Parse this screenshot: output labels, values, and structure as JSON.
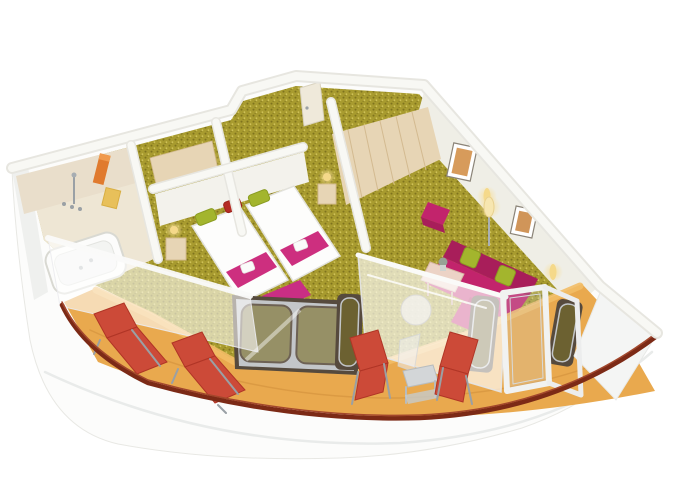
{
  "meta": {
    "description": "3D isometric cutaway rendering of a cruise-ship balcony suite floor plan",
    "width_px": 680,
    "height_px": 486
  },
  "colors": {
    "background": "#ffffff",
    "hull_white": "#fcfcfb",
    "hull_seam": "#e9ebea",
    "wall_cream": "#efeee6",
    "wall_cap": "#f8f8f4",
    "wall_cap_edge": "#e7e6e0",
    "bath_tile": "#e9decb",
    "bath_floor": "#eee6d4",
    "wood_light": "#e7d5b5",
    "wood_dark": "#d3ba90",
    "carpet_base": "#a89b2f",
    "carpet_dot_dark": "#7f731d",
    "carpet_dot_light": "#cfc258",
    "magenta": "#c2246c",
    "magenta_dark": "#a81e5a",
    "pink_runner": "#cd2f7f",
    "pink_bench": "#c92e84",
    "green_cushion": "#a3b52d",
    "red_cushion": "#b52c24",
    "lounger_red": "#cc4a38",
    "lounger_red_dark": "#b03526",
    "deck_amber": "#e9a94e",
    "deck_amber_light": "#f2bc66",
    "rail_red": "#7c2a16",
    "window_frame": "#564a3d",
    "window_glass": "rgba(122,112,42,0.62)",
    "metal_silver": "#c3c6c9",
    "frame_white": "#f1f2f1",
    "lamp_glow": "#f5d98a",
    "towel_orange": "#e07a2e",
    "towel_yellow": "#e8c05a",
    "art_orange": "#d08a3e",
    "table_pink_beige": "#ecd3c6"
  },
  "scene": {
    "type": "3d-floorplan-rendering",
    "rooms": [
      {
        "name": "bathroom",
        "features": [
          "bathtub",
          "shower-fixtures",
          "orange-towel",
          "yellow-towels",
          "tiled-walls"
        ]
      },
      {
        "name": "entrance-hall",
        "features": [
          "entry-door",
          "wood-wardrobe",
          "ceiling-light-glow"
        ]
      },
      {
        "name": "bedroom",
        "features": [
          "twin-beds",
          "white-duvets",
          "pink-bed-runners",
          "folded-towels",
          "green-pillows",
          "red-pillow",
          "bedside-tables",
          "bedside-lamps",
          "pink-bench",
          "double-window"
        ]
      },
      {
        "name": "living-room",
        "features": [
          "magenta-sofa",
          "green-cushions",
          "magenta-armchair",
          "magenta-ottoman",
          "coffee-table",
          "plant",
          "floor-lamp",
          "wall-art",
          "wall-lamps",
          "wood-wardrobe-wall"
        ]
      },
      {
        "name": "balcony",
        "features": [
          "red-sun-loungers",
          "red-folding-chairs",
          "side-table",
          "open-glass-door",
          "white-balustrade",
          "dark-red-cap-rail",
          "amber-deck",
          "translucent-windbreak"
        ]
      }
    ]
  }
}
